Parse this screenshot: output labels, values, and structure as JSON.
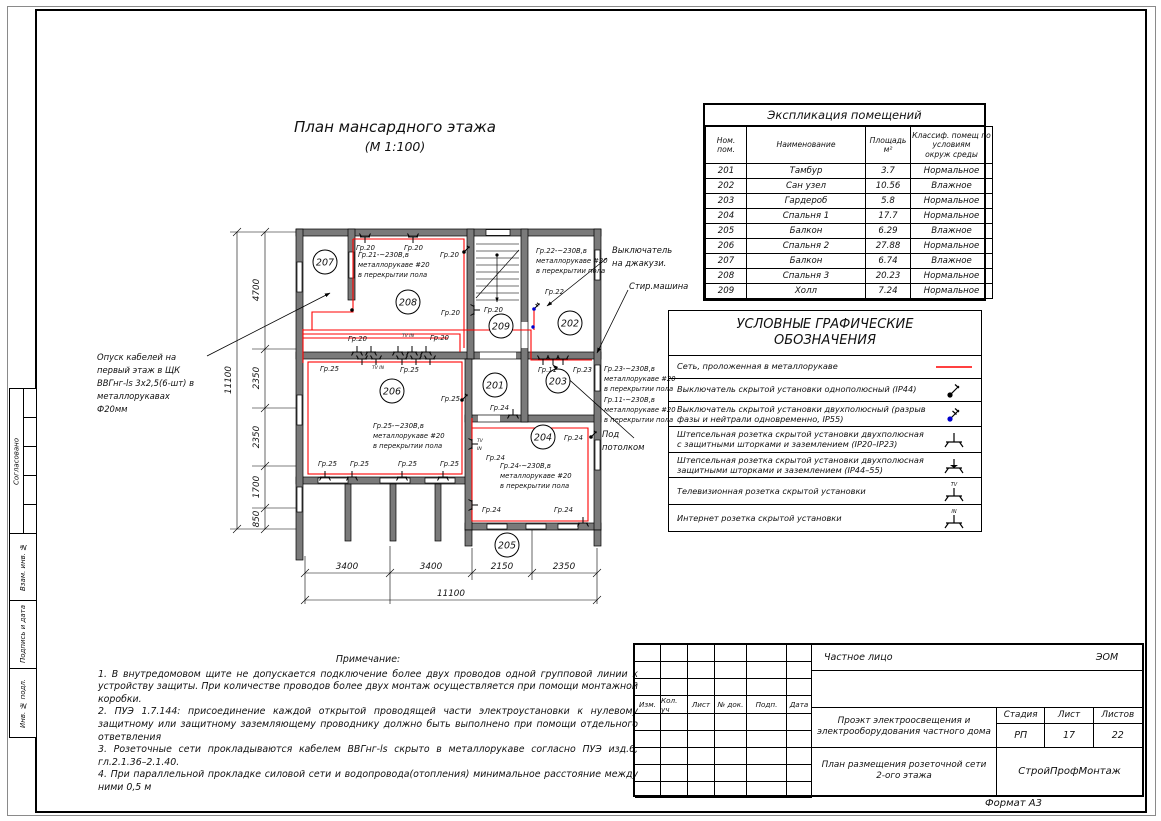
{
  "page": {
    "format_label": "Формат А3"
  },
  "colors": {
    "wire": "#ff0000",
    "wall": "#7a7a7a",
    "switch2_dot": "#0000cc"
  },
  "sidebar": {
    "boxes": [
      {
        "label": "Согласовано"
      },
      {
        "label": "Взам. инв. №"
      },
      {
        "label": "Подпись и дата"
      },
      {
        "label": "Инв. № подл."
      }
    ]
  },
  "plan": {
    "title_line1": "План мансардного этажа",
    "title_line2": "(М 1:100)",
    "rooms": [
      {
        "num": "207",
        "x": 325,
        "y": 262
      },
      {
        "num": "208",
        "x": 408,
        "y": 302
      },
      {
        "num": "209",
        "x": 501,
        "y": 326
      },
      {
        "num": "202",
        "x": 570,
        "y": 323
      },
      {
        "num": "201",
        "x": 495,
        "y": 385
      },
      {
        "num": "203",
        "x": 558,
        "y": 381
      },
      {
        "num": "206",
        "x": 392,
        "y": 391
      },
      {
        "num": "204",
        "x": 543,
        "y": 437
      },
      {
        "num": "205",
        "x": 507,
        "y": 545
      }
    ],
    "labels": [
      {
        "t": "Гр.20",
        "x": 356,
        "y": 250
      },
      {
        "t": "Гр.20",
        "x": 404,
        "y": 250
      },
      {
        "t": "Гр.20",
        "x": 440,
        "y": 257
      },
      {
        "t": "Гр.20",
        "x": 348,
        "y": 341
      },
      {
        "t": "Гр.20",
        "x": 430,
        "y": 340
      },
      {
        "t": "Гр.20",
        "x": 441,
        "y": 315
      },
      {
        "t": "Гр.20",
        "x": 484,
        "y": 312
      },
      {
        "t": "Гр.22",
        "x": 545,
        "y": 294
      },
      {
        "t": "Гр.25",
        "x": 320,
        "y": 371
      },
      {
        "t": "Гр.25",
        "x": 400,
        "y": 372
      },
      {
        "t": "Гр.25",
        "x": 441,
        "y": 401
      },
      {
        "t": "Гр.25",
        "x": 318,
        "y": 466
      },
      {
        "t": "Гр.25",
        "x": 350,
        "y": 466
      },
      {
        "t": "Гр.25",
        "x": 398,
        "y": 466
      },
      {
        "t": "Гр.25",
        "x": 440,
        "y": 466
      },
      {
        "t": "Гр.11",
        "x": 538,
        "y": 372
      },
      {
        "t": "Гр.23",
        "x": 573,
        "y": 372
      },
      {
        "t": "Гр.24",
        "x": 490,
        "y": 410
      },
      {
        "t": "Гр.24",
        "x": 486,
        "y": 460
      },
      {
        "t": "Гр.24",
        "x": 482,
        "y": 512
      },
      {
        "t": "Гр.24",
        "x": 554,
        "y": 512
      },
      {
        "t": "Гр.24",
        "x": 564,
        "y": 440
      }
    ],
    "micro_labels": [
      {
        "t": "TV IN",
        "x": 402,
        "y": 337
      },
      {
        "t": "TV IN",
        "x": 372,
        "y": 369
      },
      {
        "t": "TV",
        "x": 477,
        "y": 442
      },
      {
        "t": "IN",
        "x": 477,
        "y": 450
      }
    ],
    "group_texts": [
      {
        "x": 358,
        "y": 257,
        "lines": [
          "Гр.21-~230В,в",
          "металлорукаве #20",
          "в перекрытии пола"
        ]
      },
      {
        "x": 536,
        "y": 253,
        "lines": [
          "Гр.22-~230В,в",
          "металлорукаве #20",
          "в перекрытии пола"
        ]
      },
      {
        "x": 373,
        "y": 428,
        "lines": [
          "Гр.25-~230В,в",
          "металлорукаве #20",
          "в перекрытии пола"
        ]
      },
      {
        "x": 500,
        "y": 468,
        "lines": [
          "Гр.24-~230В,в",
          "металлорукаве #20",
          "в перекрытии пола"
        ]
      },
      {
        "x": 604,
        "y": 371,
        "lines": [
          "Гр.23-~230В,в",
          "металлорукаве #20",
          "в перекрытии пола"
        ]
      },
      {
        "x": 604,
        "y": 402,
        "lines": [
          "Гр.11-~230В,в",
          "металлорукаве #20",
          "в перекрытии пола"
        ]
      }
    ],
    "annotations": [
      {
        "x": 97,
        "y": 360,
        "lines": [
          "Опуск кабелей на",
          "первый этаж в ЩК",
          "ВВГнг-ls 3х2,5(6-шт) в",
          "металлорукавах",
          "Ф20мм"
        ]
      },
      {
        "x": 612,
        "y": 253,
        "lines": [
          "Выключатель",
          "на джакузи."
        ]
      },
      {
        "x": 629,
        "y": 289,
        "lines": [
          "Стир.машина"
        ]
      },
      {
        "x": 602,
        "y": 437,
        "lines": [
          "Под",
          "потолком"
        ]
      }
    ],
    "dims_bottom": [
      {
        "t": "3400",
        "x": 347,
        "y": 569
      },
      {
        "t": "3400",
        "x": 431,
        "y": 569
      },
      {
        "t": "2150",
        "x": 502,
        "y": 569
      },
      {
        "t": "2350",
        "x": 564,
        "y": 569
      },
      {
        "t": "11100",
        "x": 451,
        "y": 596
      }
    ],
    "dims_left": [
      {
        "t": "4700",
        "x": 259,
        "y": 290
      },
      {
        "t": "2350",
        "x": 259,
        "y": 378
      },
      {
        "t": "2350",
        "x": 259,
        "y": 437
      },
      {
        "t": "1700",
        "x": 259,
        "y": 487
      },
      {
        "t": "850",
        "x": 259,
        "y": 519
      },
      {
        "t": "11100",
        "x": 231,
        "y": 380
      }
    ],
    "sockets": [
      {
        "x": 365,
        "y": 237,
        "r": 180,
        "k": "s"
      },
      {
        "x": 413,
        "y": 237,
        "r": 180,
        "k": "s"
      },
      {
        "x": 357,
        "y": 352,
        "r": 0,
        "k": "s"
      },
      {
        "x": 371,
        "y": 352,
        "r": 0,
        "k": "s"
      },
      {
        "x": 398,
        "y": 352,
        "r": 0,
        "k": "s"
      },
      {
        "x": 412,
        "y": 352,
        "r": 0,
        "k": "s"
      },
      {
        "x": 426,
        "y": 352,
        "r": 0,
        "k": "s"
      },
      {
        "x": 362,
        "y": 359,
        "r": 180,
        "k": "s"
      },
      {
        "x": 376,
        "y": 359,
        "r": 180,
        "k": "s"
      },
      {
        "x": 402,
        "y": 359,
        "r": 180,
        "k": "s"
      },
      {
        "x": 416,
        "y": 359,
        "r": 180,
        "k": "s"
      },
      {
        "x": 430,
        "y": 359,
        "r": 180,
        "k": "s"
      },
      {
        "x": 543,
        "y": 359,
        "r": 180,
        "k": "s"
      },
      {
        "x": 553,
        "y": 359,
        "r": 180,
        "k": "s"
      },
      {
        "x": 563,
        "y": 359,
        "r": 180,
        "k": "s"
      },
      {
        "x": 325,
        "y": 477,
        "r": 0,
        "k": "s"
      },
      {
        "x": 352,
        "y": 477,
        "r": 0,
        "k": "s"
      },
      {
        "x": 402,
        "y": 477,
        "r": 0,
        "k": "s"
      },
      {
        "x": 443,
        "y": 477,
        "r": 0,
        "k": "s"
      },
      {
        "x": 472,
        "y": 444,
        "r": 90,
        "k": "s"
      },
      {
        "x": 472,
        "y": 505,
        "r": 90,
        "k": "s"
      },
      {
        "x": 583,
        "y": 523,
        "r": 0,
        "k": "s"
      },
      {
        "x": 513,
        "y": 415,
        "r": 0,
        "k": "s"
      },
      {
        "x": 474,
        "y": 310,
        "r": 90,
        "k": "s"
      },
      {
        "x": 464,
        "y": 252,
        "r": 0,
        "k": "w"
      },
      {
        "x": 462,
        "y": 400,
        "r": 0,
        "k": "w"
      },
      {
        "x": 591,
        "y": 437,
        "r": 0,
        "k": "w"
      },
      {
        "x": 534,
        "y": 309,
        "r": 0,
        "k": "w2"
      }
    ]
  },
  "exploitation": {
    "title": "Экспликация помещений",
    "headers": [
      "Ном.\nпом.",
      "Наименование",
      "Площадь\nм²",
      "Классиф. помещ по\nусловиям\nокруж среды"
    ],
    "rows": [
      [
        "201",
        "Тамбур",
        "3.7",
        "Нормальное"
      ],
      [
        "202",
        "Сан узел",
        "10.56",
        "Влажное"
      ],
      [
        "203",
        "Гардероб",
        "5.8",
        "Нормальное"
      ],
      [
        "204",
        "Спальня 1",
        "17.7",
        "Нормальное"
      ],
      [
        "205",
        "Балкон",
        "6.29",
        "Влажное"
      ],
      [
        "206",
        "Спальня 2",
        "27.88",
        "Нормальное"
      ],
      [
        "207",
        "Балкон",
        "6.74",
        "Влажное"
      ],
      [
        "208",
        "Спальня 3",
        "20.23",
        "Нормальное"
      ],
      [
        "209",
        "Холл",
        "7.24",
        "Нормальное"
      ]
    ]
  },
  "legend": {
    "title_line1": "УСЛОВНЫЕ ГРАФИЧЕСКИЕ",
    "title_line2": "ОБОЗНАЧЕНИЯ",
    "items": [
      {
        "text": "Сеть, проложенная в металлорукаве",
        "symbol": "red-line"
      },
      {
        "text": "Выключатель скрытой установки однополюсный (IP44)",
        "symbol": "switch-1p"
      },
      {
        "text": "Выключатель скрытой установки двухполюсный (разрыв фазы и нейтрали одновременно, IP55)",
        "symbol": "switch-2p"
      },
      {
        "text": "Штепсельная розетка скрытой установки двухполюсная с защитными шторками и заземлением (IP20–IP23)",
        "symbol": "socket"
      },
      {
        "text": "Штепсельная розетка скрытой установки двухполюсная защитными шторками и заземлением (IP44–55)",
        "symbol": "socket-ip44"
      },
      {
        "text": "Телевизионная розетка скрытой установки",
        "symbol": "socket-tv"
      },
      {
        "text": "Интернет розетка скрытой установки",
        "symbol": "socket-in"
      }
    ]
  },
  "notes": {
    "title": "Примечание:",
    "lines": [
      "1.  В внутредомовом щите не допускается подключение более двух проводов одной групповой линии к устройству защиты. При количестве проводов более двух монтаж осуществляется при помощи монтажной коробки.",
      "2.  ПУЭ 1.7.144:  присоединение каждой открытой проводящей части электроустановки к нулевому защитному или защитному заземляющему проводнику должно быть выполнено при помощи отдельного ответвления",
      "3.  Розеточные сети прокладываются кабелем ВВГнг-ls скрыто в металлорукаве согласно ПУЭ изд.6,  гл.2.1.36–2.1.40.",
      "4.  При параллельной прокладке силовой сети и водопровода(отопления) минимальное расстояние между ними 0,5 м"
    ]
  },
  "titleblock": {
    "customer": "Частное лицо",
    "code": "ЭОМ",
    "rev_headers": [
      "Изм.",
      "Кол. уч",
      "Лист",
      "№ док.",
      "Подп.",
      "Дата"
    ],
    "project": "Проэкт электроосвещения и электрооборудования  частного дома",
    "stage_label": "Стадия",
    "sheet_label": "Лист",
    "sheets_label": "Листов",
    "stage": "РП",
    "sheet": "17",
    "sheets": "22",
    "drawing": "План размещения розеточной сети 2-ого этажа",
    "company": "СтройПрофМонтаж"
  }
}
